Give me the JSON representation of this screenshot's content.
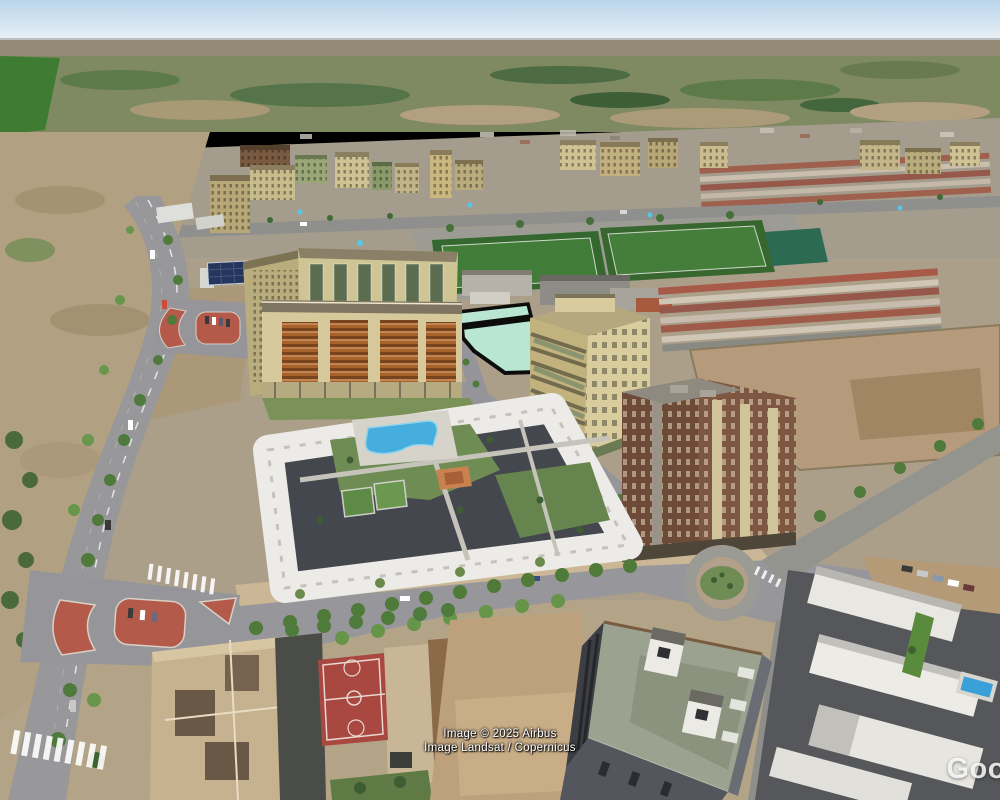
{
  "attribution": {
    "line1": "Image © 2025 Airbus",
    "line2": "Image Landsat / Copernicus"
  },
  "watermark": {
    "text": "Goo"
  },
  "colors": {
    "sky_top": "#b9d4ea",
    "sky_bottom": "#e6eff6",
    "parcel_fill": "#b9e6d3",
    "parcel_outline": "#0c0c0c",
    "pool": "#45aede",
    "small_pool": "#3aa0d8",
    "sports_field": "#417c38",
    "basketball_court": "#a84840",
    "cream_building": "#d6c99b",
    "orange_facade": "#a8622c",
    "brown_tower": "#6e4a38",
    "white_complex": "#ecebe7",
    "road": "#98989a",
    "scrubland": "#b2a083",
    "countryside": "#7f8a63"
  }
}
